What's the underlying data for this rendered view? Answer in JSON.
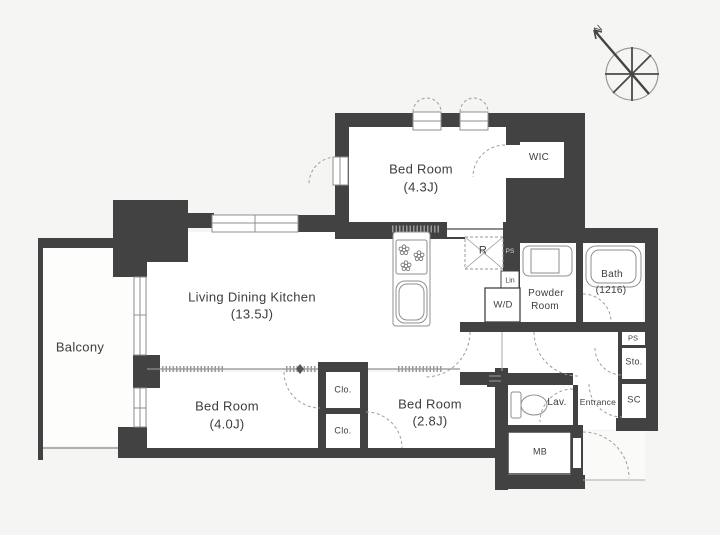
{
  "plan_title": "apartment-floor-plan",
  "colors": {
    "wall": "#424242",
    "line": "#8f8f8f",
    "dashed_door": "#9e9e9e",
    "text": "#3d3d3d",
    "background": "#f5f5f3",
    "room_fill": "#ffffff"
  },
  "compass": {
    "north_label": "N"
  },
  "rooms": {
    "living_dining_kitchen": {
      "label": "Living Dining Kitchen",
      "size": "(13.5J)"
    },
    "bedroom_top": {
      "label": "Bed Room",
      "size": "(4.3J)"
    },
    "bedroom_left": {
      "label": "Bed Room",
      "size": "(4.0J)"
    },
    "bedroom_right": {
      "label": "Bed Room",
      "size": "(2.8J)"
    },
    "balcony": {
      "label": "Balcony"
    },
    "wic": {
      "label": "WIC"
    },
    "powder_room": {
      "label_line1": "Powder",
      "label_line2": "Room"
    },
    "bath": {
      "label": "Bath",
      "size": "(1216)"
    },
    "lavatory": {
      "label": "Lav."
    },
    "entrance": {
      "label": "Entrance"
    }
  },
  "fixtures": {
    "refrigerator_space": {
      "label": "R"
    },
    "washer_dryer": {
      "label": "W/D"
    },
    "linen_shelf": {
      "label": "Lin"
    },
    "pipe_space_kitchen": {
      "label": "PS"
    },
    "pipe_space_entry": {
      "label": "PS"
    },
    "storage": {
      "label": "Sto."
    },
    "shoe_closet": {
      "label": "SC"
    },
    "meter_box": {
      "label": "MB"
    },
    "closet_upper": {
      "label": "Clo."
    },
    "closet_lower": {
      "label": "Clo."
    }
  }
}
